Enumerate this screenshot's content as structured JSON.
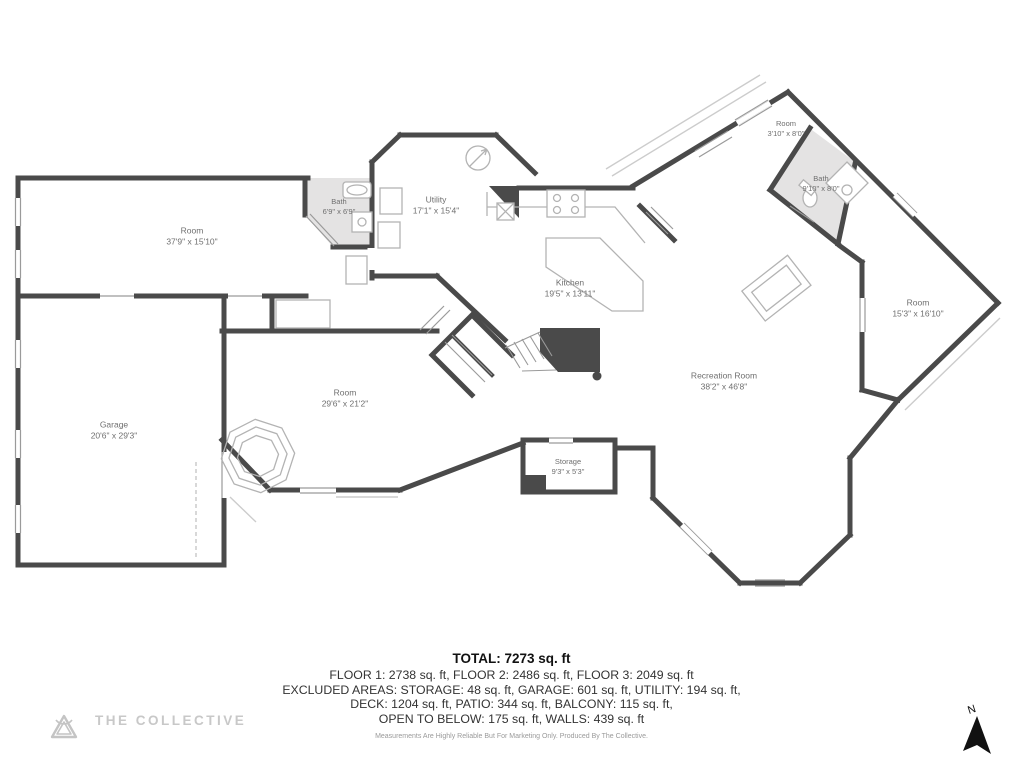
{
  "plan": {
    "rooms": [
      {
        "name": "Room",
        "dims": "37'9\" x 15'10\""
      },
      {
        "name": "Bath",
        "dims": "6'9\" x 6'9\""
      },
      {
        "name": "Utility",
        "dims": "17'1\" x 15'4\""
      },
      {
        "name": "Kitchen",
        "dims": "19'5\" x 13'11\""
      },
      {
        "name": "Room",
        "dims": "3'10\" x 8'0\""
      },
      {
        "name": "Bath",
        "dims": "9'10\" x 8'0\""
      },
      {
        "name": "Room",
        "dims": "15'3\" x 16'10\""
      },
      {
        "name": "Recreation Room",
        "dims": "38'2\" x 46'8\""
      },
      {
        "name": "Garage",
        "dims": "20'6\" x 29'3\""
      },
      {
        "name": "Room",
        "dims": "29'6\" x 21'2\""
      },
      {
        "name": "Storage",
        "dims": "9'3\" x 5'3\""
      }
    ],
    "compass_label": "N"
  },
  "summary": {
    "total": "TOTAL: 7273 sq. ft",
    "lines": [
      "FLOOR 1: 2738 sq. ft, FLOOR 2: 2486 sq. ft, FLOOR 3: 2049 sq. ft",
      "EXCLUDED AREAS: STORAGE: 48 sq. ft, GARAGE: 601 sq. ft, UTILITY: 194 sq. ft,",
      "DECK: 1204 sq. ft, PATIO: 344 sq. ft, BALCONY: 115 sq. ft,",
      "OPEN TO BELOW: 175 sq. ft, WALLS: 439 sq. ft"
    ],
    "disclaimer": "Measurements Are Highly Reliable But For Marketing Only. Produced By The Collective."
  },
  "branding": {
    "name": "THE COLLECTIVE"
  },
  "colors": {
    "wall": "#4a4a4a",
    "bath_fill": "#e4e3e3",
    "fixture_line": "#b3b3b3",
    "label_text": "#6f6f6f",
    "brand_text": "#c8c8c8",
    "north_arrow": "#111111"
  }
}
